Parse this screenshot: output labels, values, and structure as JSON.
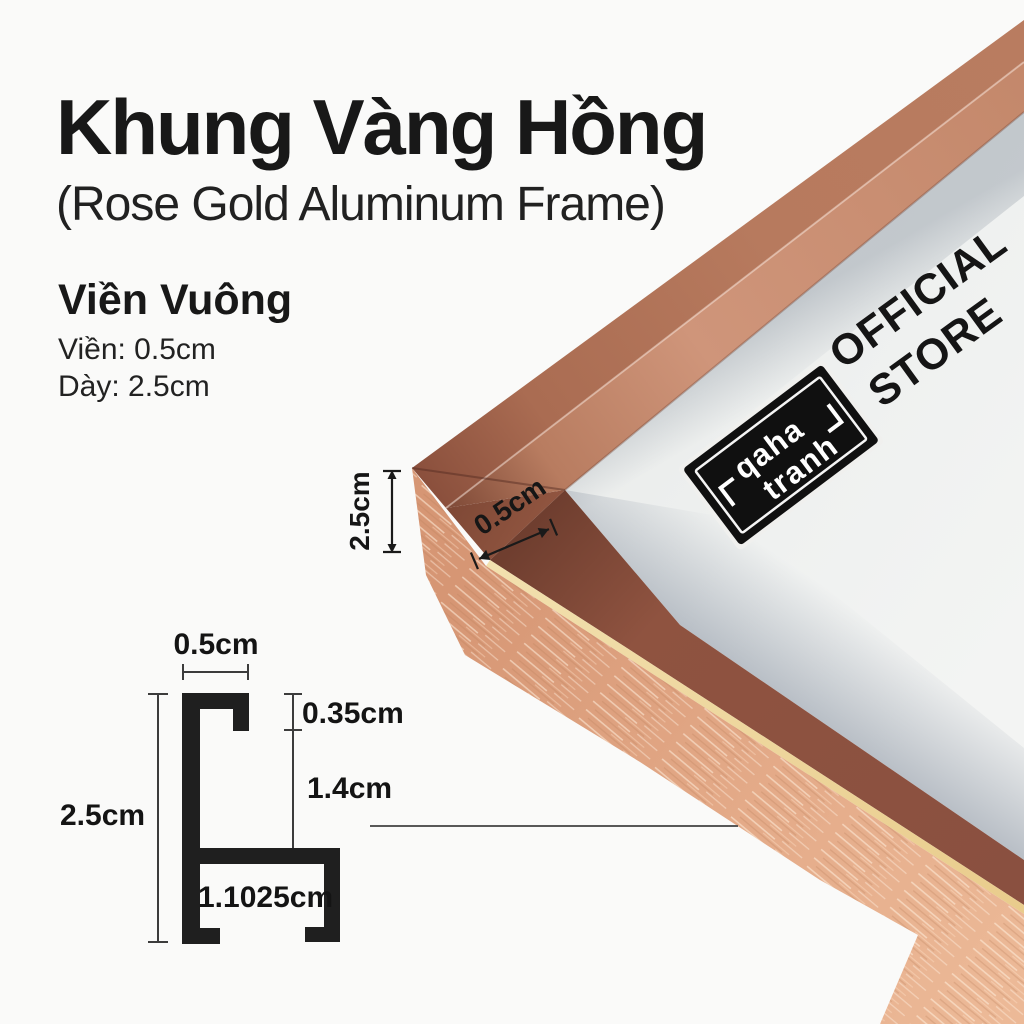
{
  "header": {
    "title": "Khung Vàng Hồng",
    "subtitle": "(Rose Gold Aluminum Frame)"
  },
  "specs": {
    "heading": "Viền Vuông",
    "border_label": "Viền: 0.5cm",
    "thickness_label": "Dày: 2.5cm"
  },
  "photo": {
    "depth_annotation": "2.5cm",
    "lip_annotation": "0.5cm",
    "sticker_line1": "qaha",
    "sticker_line2": "tranh",
    "official_line1": "OFFICIAL",
    "official_line2": "STORE"
  },
  "diagram": {
    "top_width": "0.5cm",
    "lip_depth": "0.35cm",
    "inner_height": "1.4cm",
    "total_height": "2.5cm",
    "base_width": "1.1025cm"
  },
  "colors": {
    "background": "#fafaf9",
    "text": "#181818",
    "profile_black": "#1f1f1f",
    "rose_outer_face": "#b77a5e",
    "rose_lip_face": "#cf957a",
    "rose_dark_face": "#8f5340",
    "gold_pinstripe": "#e9cc8c",
    "brushed_face": "#e3a987",
    "paper": "#eff1f0"
  }
}
